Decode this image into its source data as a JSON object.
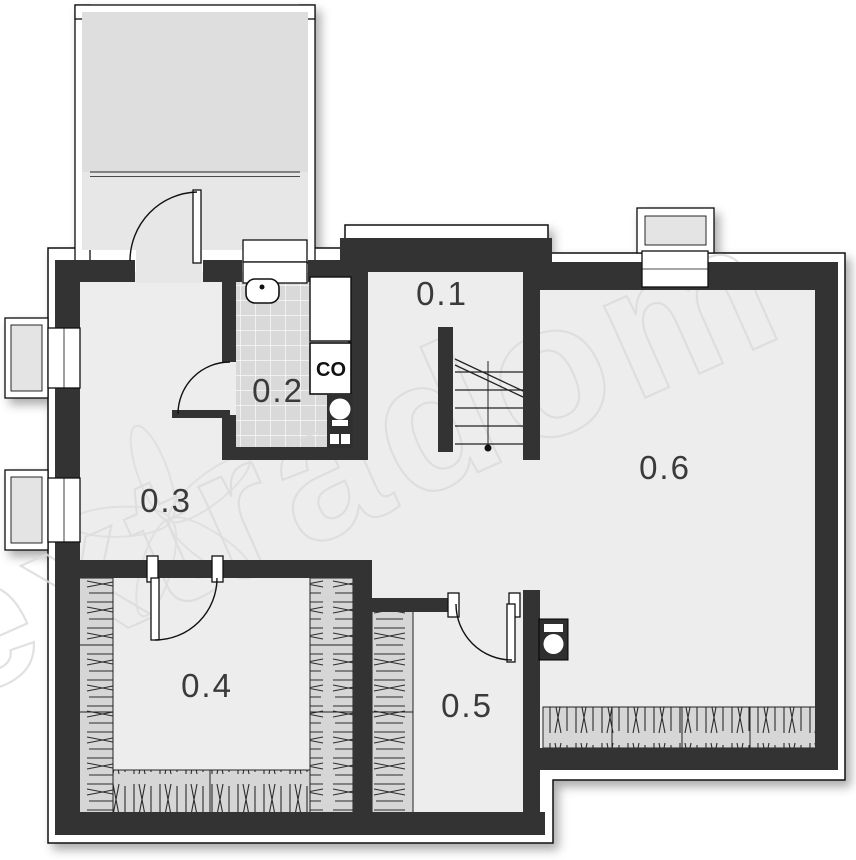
{
  "plan": {
    "type": "floor-plan",
    "level": "basement",
    "rooms": [
      {
        "label": "0.1"
      },
      {
        "label": "0.2"
      },
      {
        "label": "0.3"
      },
      {
        "label": "0.4"
      },
      {
        "label": "0.5"
      },
      {
        "label": "0.6"
      }
    ],
    "boiler_label": "CO",
    "watermark": "extradom",
    "colors": {
      "wall": "#333333",
      "floor": "#ededed",
      "tile_floor": "#d9d9d9",
      "insulation_hatch": "#d6d6d6",
      "garage_floor": "#dedede",
      "outline": "#ffffff",
      "watermark_stroke": "#dcdcdc"
    }
  }
}
